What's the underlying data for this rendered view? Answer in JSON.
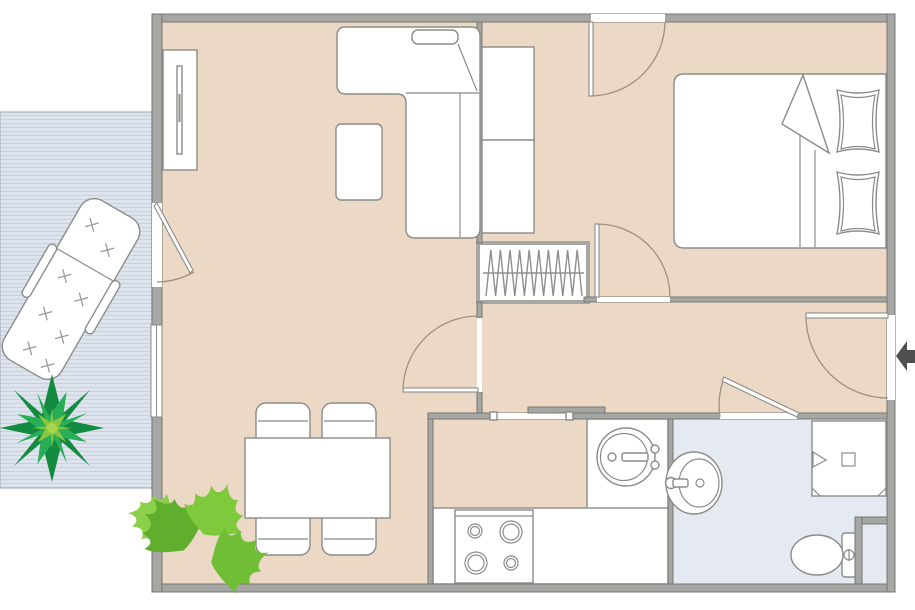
{
  "title": "apartment-floor-plan",
  "colors": {
    "floor": "#ecd9c5",
    "wall": "#a6a6a4",
    "wall_edge": "#76766f",
    "bathroom_floor": "#e4e9f2",
    "balcony_floor": "#dde4ee",
    "balcony_stripe": "#c7d1df",
    "furniture_stroke": "#8b8b89",
    "door_arc": "#a0907f",
    "entry_arrow": "#4f4f4f",
    "plant_dark": "#128a3f",
    "plant_mid": "#27ae57",
    "plant_light": "#8cc63f",
    "monstera_1": "#5fae2e",
    "monstera_2": "#7fc93c",
    "monstera_3": "#6fbe35",
    "monstera_4": "#8ccf4a"
  },
  "objects": [
    "l-shaped-sofa",
    "coffee-table",
    "tv-unit",
    "wardrobe",
    "bed",
    "bed-pillows",
    "radiator",
    "dining-table",
    "dining-chairs",
    "kitchen-counter",
    "stove",
    "kitchen-sink",
    "bathroom-sink",
    "shower",
    "toilet",
    "lounge-chair",
    "agave-plant",
    "monstera-plant",
    "entry-arrow",
    "hinged-doors",
    "sliding-door",
    "window",
    "balcony"
  ],
  "entry_arrow_direction": "left"
}
